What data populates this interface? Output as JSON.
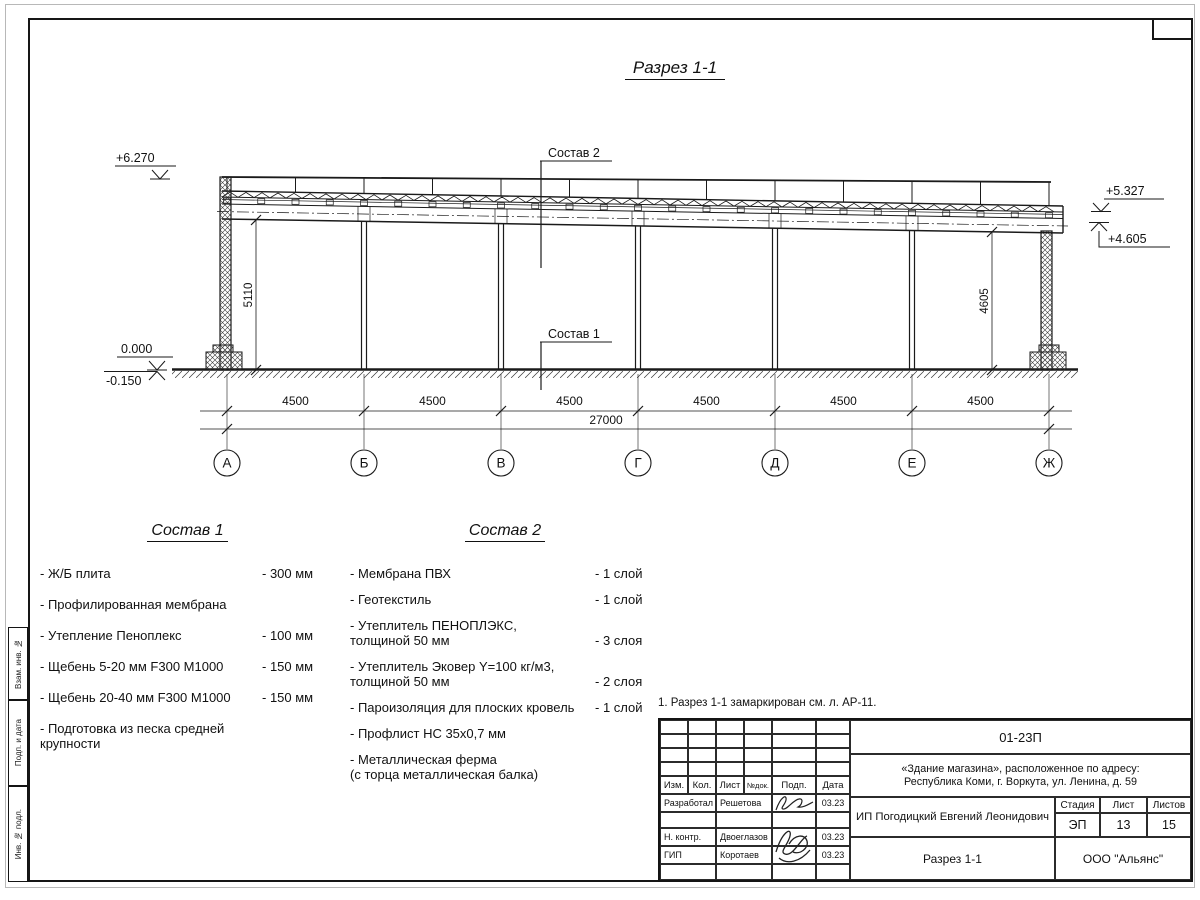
{
  "page": {
    "title": "Разрез 1-1"
  },
  "drawing": {
    "labels": {
      "sostav1": "Состав 1",
      "sostav2": "Состав 2"
    },
    "elevations": {
      "top_left": "+6.270",
      "zero": "0.000",
      "minus": "-0.150",
      "right_upper": "+5.327",
      "right_lower": "+4.605"
    },
    "vertical_dims": {
      "left": "5110",
      "right": "4605"
    },
    "bay_dims": [
      "4500",
      "4500",
      "4500",
      "4500",
      "4500",
      "4500"
    ],
    "total_dim": "27000",
    "axes": [
      "А",
      "Б",
      "В",
      "Г",
      "Д",
      "Е",
      "Ж"
    ]
  },
  "composition1": {
    "title": "Состав 1",
    "items": [
      {
        "name": "- Ж/Б плита",
        "value": "- 300 мм"
      },
      {
        "name": "- Профилированная мембрана",
        "value": ""
      },
      {
        "name": "- Утепление Пеноплекс",
        "value": "- 100 мм"
      },
      {
        "name": "-  Щебень 5-20 мм F300 М1000",
        "value": "- 150 мм"
      },
      {
        "name": "-  Щебень 20-40 мм F300 М1000",
        "value": "- 150 мм"
      },
      {
        "name": "- Подготовка из песка средней\nкрупности",
        "value": ""
      }
    ]
  },
  "composition2": {
    "title": "Состав 2",
    "items": [
      {
        "name": "- Мембрана ПВХ",
        "value": "- 1 слой"
      },
      {
        "name": "- Геотекстиль",
        "value": "- 1 слой"
      },
      {
        "name": "- Утеплитель ПЕНОПЛЭКС,\nтолщиной 50 мм",
        "value": "- 3 слоя"
      },
      {
        "name": "- Утеплитель Эковер Y=100 кг/м3,\nтолщиной 50 мм",
        "value": "- 2 слоя"
      },
      {
        "name": "- Пароизоляция для плоских кровель",
        "value": "- 1 слой"
      },
      {
        "name": "- Профлист НС 35х0,7 мм",
        "value": ""
      },
      {
        "name": "- Металлическая ферма\n(с торца металлическая балка)",
        "value": ""
      }
    ]
  },
  "note": "1. Разрез 1-1 замаркирован см. л. АР-11.",
  "title_block": {
    "doc_number": "01-23П",
    "object_line1": "«Здание магазина», расположенное по адресу:",
    "object_line2": "Республика Коми, г. Воркута, ул. Ленина, д. 59",
    "columns": {
      "izm": "Изм.",
      "kol": "Кол.",
      "list": "Лист",
      "ndok": "№док.",
      "podp": "Подп.",
      "data": "Дата"
    },
    "rows": [
      {
        "role": "Разработал",
        "name": "Решетова",
        "date": "03.23"
      },
      {
        "role": "Н. контр.",
        "name": "Двоеглазов",
        "date": "03.23"
      },
      {
        "role": "ГИП",
        "name": "Коротаев",
        "date": "03.23"
      }
    ],
    "client": "ИП Погодицкий Евгений Леонидович",
    "stage_label": "Стадия",
    "stage": "ЭП",
    "sheet_label": "Лист",
    "sheet": "13",
    "sheets_label": "Листов",
    "sheets": "15",
    "sheet_title": "Разрез 1-1",
    "org": "ООО \"Альянс\""
  },
  "margin_labels": [
    "Взам. инв. №",
    "Подп. и дата",
    "Инв. № подл."
  ]
}
